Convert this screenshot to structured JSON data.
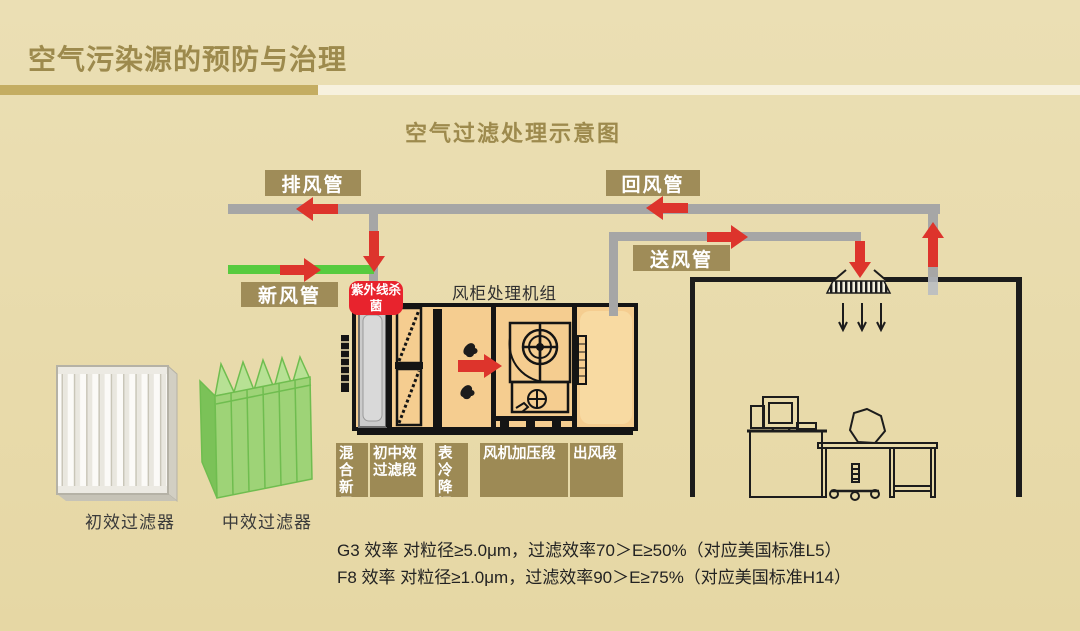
{
  "slide": {
    "title": "空气污染源的预防与治理",
    "subtitle": "空气过滤处理示意图"
  },
  "labels": {
    "exhaust_duct": "排风管",
    "return_duct": "回风管",
    "fresh_duct": "新风管",
    "supply_duct": "送风管",
    "uv": "紫外线杀菌",
    "ahu_title": "风柜处理机组"
  },
  "ahu_sections": [
    {
      "label": "混合新风段"
    },
    {
      "label": "初中效过滤段"
    },
    {
      "label": "表冷降温段"
    },
    {
      "label": "风机加压段"
    },
    {
      "label": "出风段"
    }
  ],
  "filters": [
    {
      "caption": "初效过滤器"
    },
    {
      "caption": "中效过滤器"
    }
  ],
  "notes": [
    "G3 效率 对粒径≥5.0μm，过滤效率70＞E≥50%（对应美国标准L5）",
    "F8 效率 对粒径≥1.0μm，过滤效率90＞E≥75%（对应美国标准H14）"
  ],
  "colors": {
    "background": "#e9dcae",
    "title_gold": "#9d8a4d",
    "label_box_gold": "#9f8c58",
    "underline_dark": "#c4ad62",
    "underline_light": "#f7f1de",
    "duct_gray": "#a6a6a6",
    "fresh_air_green": "#57cb3f",
    "arrow_red": "#dd342c",
    "uv_badge_red": "#e8232d",
    "ahu_interior": "#f5cd90"
  }
}
